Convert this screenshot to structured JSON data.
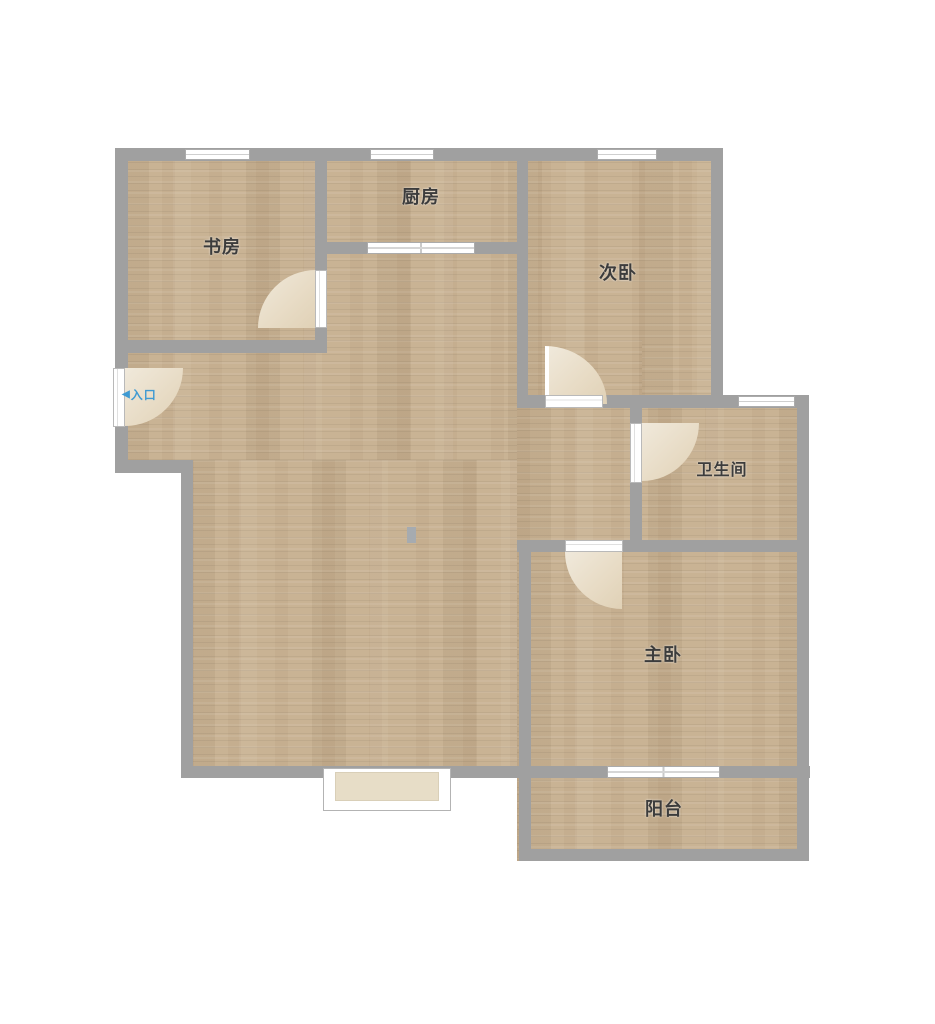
{
  "rooms": [
    {
      "key": "study",
      "label": "书房"
    },
    {
      "key": "kitchen",
      "label": "厨房"
    },
    {
      "key": "secondary_bedroom",
      "label": "次卧"
    },
    {
      "key": "bathroom",
      "label": "卫生间"
    },
    {
      "key": "master_bedroom",
      "label": "主卧"
    },
    {
      "key": "balcony",
      "label": "阳台"
    }
  ],
  "entrance": {
    "arrow": "◀",
    "label": "入口"
  },
  "colors": {
    "background": "#ffffff",
    "wall_gray": "#a0a0a0",
    "floor_wood": "#c9b394",
    "door_swing_beige": "#e8dcc6",
    "window_white": "#ffffff",
    "bay_window_fill": "#e7ddc7",
    "entrance_blue": "#3f9ad2",
    "label_text": "#3c3c3c"
  }
}
